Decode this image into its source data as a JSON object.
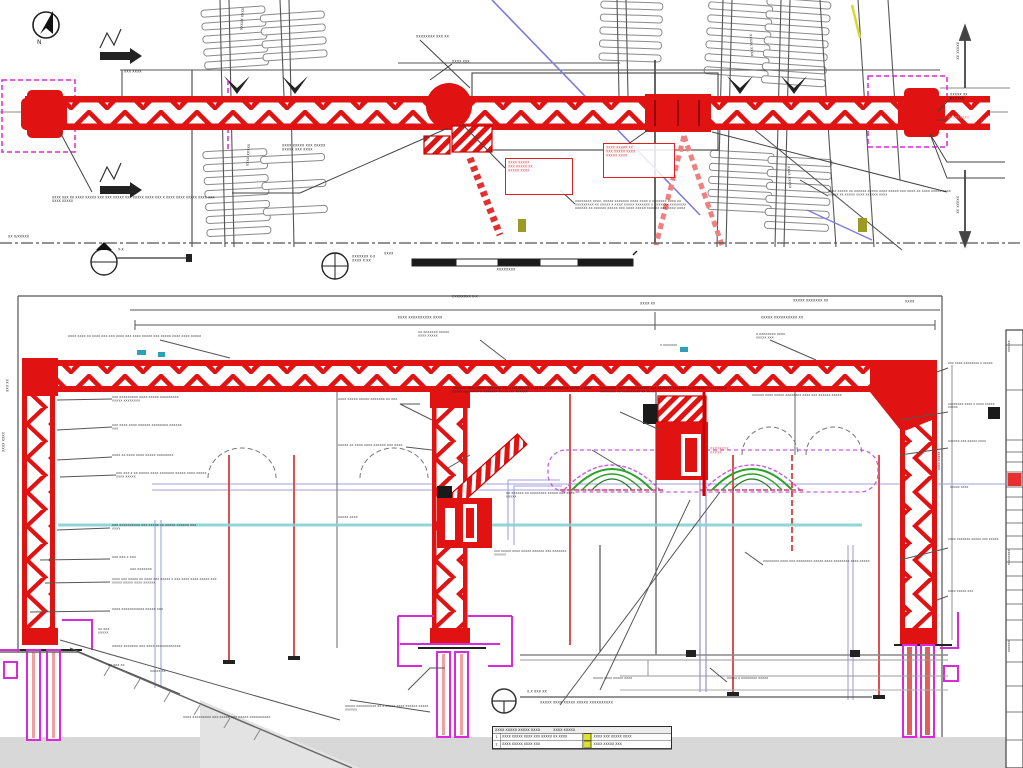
{
  "meta": {
    "drawing_type": "engineering CAD drawing — temporary gantry truss over railway: plan view (top) and elevation/section view (bottom)"
  },
  "colors": {
    "truss_red": "#e01212",
    "magenta": "#d92ad9",
    "cyan_level": "#85d2d4",
    "green_envelope": "#2ba32b",
    "purple_envelope": "#c55ddd",
    "lavender_line": "#a2a2dd",
    "blue_line": "#7d7de0",
    "yellow_mark": "#d8d82e",
    "ground_grey": "#d8d8d8",
    "legend_yellow": "#dede3a",
    "ink": "#1c1c1c"
  },
  "plan": {
    "annotations": [
      {
        "t": "XXXX XXXXX XXX XXXXX\nXXXXX XXX XXXX",
        "x": 282,
        "y": 144,
        "w": 86
      },
      {
        "t": "XXXX XXX XX XXXX XXXXX XXX XXX XXXXX XXX XXXXX XXXX XXX X XXXX XXXX XXXXX XXXX XXX XXXX XXXXX",
        "x": 52,
        "y": 196,
        "w": 168,
        "fs": 6.2
      },
      {
        "t": "XXXXXXXX XXXX. XXXXX XXXXXXX XXXX XXXX X XXXXXXX XXXX XX XXXXXXXXX XX XXXXX X XXXX XXXXX XXXXXXX X XXXXXXX XXXXXXXX XXXXXX XX XXXXXX XXXXX XXX XXXX XXXXX XXXXXX XXX XXXX XXXX",
        "x": 575,
        "y": 200,
        "w": 112,
        "fs": 5.8
      },
      {
        "t": "XXXX XXXXX XX XXXXXX XXXXX XXXX XXXXX XXX XXXX XX XXXX XXXXX XXXX XXXXX XX XXXXX XXXX XXXXXX XXXX",
        "x": 828,
        "y": 190,
        "w": 130,
        "fs": 5.8
      },
      {
        "t": "XXXXX XX\nXXXXXX",
        "x": 950,
        "y": 93,
        "w": 56
      },
      {
        "t": "XXXXXXXXX",
        "x": 948,
        "y": 116,
        "w": 60,
        "c": "#e87070"
      },
      {
        "t": "XXXXXXXX XXX XX",
        "x": 416,
        "y": 35,
        "w": 78
      },
      {
        "t": "XXXX XXX",
        "x": 452,
        "y": 60,
        "w": 50
      },
      {
        "t": "XXXXX XXXX",
        "x": 240,
        "y": 30,
        "r": -86
      },
      {
        "t": "XXXXX XXXX",
        "x": 752,
        "y": 34,
        "r": 86
      },
      {
        "t": "XXXX XXXXX",
        "x": 790,
        "y": 166,
        "r": 86
      },
      {
        "t": "XXXX XXXXX",
        "x": 246,
        "y": 166,
        "r": -86
      },
      {
        "t": "XXX XXXX",
        "x": 124,
        "y": 70,
        "w": 48
      },
      {
        "t": "XXXXX XX",
        "x": 959,
        "y": 42,
        "r": 90
      },
      {
        "t": "XXXXX XX",
        "x": 959,
        "y": 196,
        "r": 90
      },
      {
        "t": "XX X/XXXXX",
        "x": 8,
        "y": 235,
        "w": 58
      },
      {
        "t": "X-X",
        "x": 118,
        "y": 248,
        "w": 30
      }
    ],
    "callouts": [
      {
        "t": "XXXX XXXXX\nXXX XXXXX XX\nXXXXX XXXX",
        "x": 505,
        "y": 158,
        "w": 62,
        "h": 32
      },
      {
        "t": "XXXX XXXXX XX\nXXX XXXXX XXXX\nXXXXX XXXX",
        "x": 603,
        "y": 143,
        "w": 66,
        "h": 30
      }
    ]
  },
  "gap": {
    "annotations": [
      {
        "t": "XXXXXXX X-X\nXXXX X:XX",
        "x": 352,
        "y": 255,
        "w": 82
      },
      {
        "t": "XXXXXXXX",
        "x": 468,
        "y": 268,
        "w": 76,
        "ta": "center"
      },
      {
        "t": "XXXX",
        "x": 384,
        "y": 252,
        "w": 36
      }
    ]
  },
  "elevation": {
    "annotations": [
      {
        "t": "XXXX XXXX XX XXXX XXX XXX XXXX XXX XXXX XXXXX XXX XXXXX XXXX XXXX XXXXX",
        "x": 68,
        "y": 335,
        "w": 150,
        "fs": 5.8
      },
      {
        "t": "XX XXXXXXX XXXXX\nXXXX XXXXX",
        "x": 418,
        "y": 331,
        "w": 92,
        "fs": 5.8
      },
      {
        "t": "X XXXXXXXX XXXX\nXXXXX XXX",
        "x": 756,
        "y": 333,
        "w": 86,
        "fs": 5.8
      },
      {
        "t": "XXX XXXXXXXXX XXXX XXXXX XXXXXXXXX XXXXX XXXXXXXX",
        "x": 112,
        "y": 396,
        "w": 78,
        "fs": 5.8
      },
      {
        "t": "XXX XXXX XXXX XXXXXX XXXXXXXX XXXXXX XXX",
        "x": 112,
        "y": 424,
        "w": 74,
        "fs": 5.8
      },
      {
        "t": "XXXX XX XXXX XXXX XXXXX XXXXXXXX",
        "x": 112,
        "y": 454,
        "w": 62,
        "fs": 5.8
      },
      {
        "t": "XXX XXX X XX XXXXX XXXX XXXXXXX XXXXX XXXX XXXXX XXXX XXXXX",
        "x": 116,
        "y": 472,
        "w": 96,
        "fs": 5.8
      },
      {
        "t": "XXX XXXXXXXXXX XXX XXXXX XX XXXXX XXXXXX XXX XXXX",
        "x": 112,
        "y": 524,
        "w": 92,
        "fs": 5.8
      },
      {
        "t": "XXX XXX X XXX",
        "x": 112,
        "y": 556,
        "w": 70,
        "fs": 5.8
      },
      {
        "t": "XXX XXXXXXX",
        "x": 130,
        "y": 568,
        "w": 56,
        "fs": 5.8
      },
      {
        "t": "XXXX XXX XXXXX XX XXXX XXX XXXXX X XXX XXXX XXXX XXXXX XXX XXXXX XXXXX XXXX XXXXXX",
        "x": 112,
        "y": 578,
        "w": 112,
        "fs": 5.6
      },
      {
        "t": "XXXX XXXXXXXXXXX XXXXX XXX",
        "x": 112,
        "y": 608,
        "w": 70,
        "fs": 5.8
      },
      {
        "t": "XX XXX\nXXXXX",
        "x": 98,
        "y": 628,
        "w": 40,
        "fs": 5.8
      },
      {
        "t": "XXXXX XXXXXXX XXX XXXX XXXXXXXXXXXX",
        "x": 112,
        "y": 645,
        "w": 88,
        "fs": 5.8
      },
      {
        "t": "XX XXX XX",
        "x": 108,
        "y": 664,
        "w": 48,
        "fs": 5.8
      },
      {
        "t": "XXXXX XX",
        "x": 150,
        "y": 670,
        "w": 42,
        "fs": 5.8
      },
      {
        "t": "XXXX XXXXXXXXX XXX XXXXX XXX XXXXX XXXXXXXXXX",
        "x": 183,
        "y": 716,
        "w": 110,
        "fs": 5.8
      },
      {
        "t": "XXXX XXXXX XXXXX XXXXXXX XX XXX",
        "x": 338,
        "y": 398,
        "w": 80,
        "fs": 5.8
      },
      {
        "t": "XXXXX XX XXXX XXXX XXXXXX XXX XXXX",
        "x": 338,
        "y": 444,
        "w": 68,
        "fs": 5.8
      },
      {
        "t": "XXXXX XXXX",
        "x": 338,
        "y": 516,
        "w": 56,
        "fs": 5.8
      },
      {
        "t": "XXXXXXX XXXX XXXXX XXXXXXX XXX XXXXXXXXXX XXXX XXXXXXXXXXXX XX XXXXX X XXXX XXXXX XXXXXXXX X XXXXXXX XXXXXXXX XXXXXX",
        "x": 452,
        "y": 387,
        "w": 140,
        "fs": 5.6
      },
      {
        "t": "XXXXXXXX XXXX XXXXX XXXXXX XXX XXXXXXX XXXXXXX XX XXXXXXX X XXXXXXXX XXXXXXXX XX XXXXXXXXX XX XXXXX",
        "x": 600,
        "y": 387,
        "w": 140,
        "fs": 5.6
      },
      {
        "t": "XX XXXXXX XX XXXXXXXX XXXXX XXX XXXX XXXXX",
        "x": 506,
        "y": 492,
        "w": 76,
        "fs": 5.8
      },
      {
        "t": "XXX XXXXX XXXX XXXXX XXXXXX XXX XXXXXXX XXXXXX",
        "x": 494,
        "y": 550,
        "w": 84,
        "fs": 5.6
      },
      {
        "t": "XXXXXXXX\nXXXXX",
        "x": 710,
        "y": 447,
        "w": 60,
        "c": "#e05555"
      },
      {
        "t": "XXXXXX XXXX XXXXX XXXXXXXX XXXX XXX XXXXXX XXXXX",
        "x": 752,
        "y": 394,
        "w": 98,
        "fs": 5.6
      },
      {
        "t": "XXX XXXX XXXXXXXX X XXXXX",
        "x": 948,
        "y": 362,
        "w": 56,
        "fs": 5.4
      },
      {
        "t": "XXXXXXXX XXXX X XXXX XXXXX XXXXX",
        "x": 948,
        "y": 403,
        "w": 56,
        "fs": 5.4
      },
      {
        "t": "XXXXXX XXX XXXXX XXXX",
        "x": 948,
        "y": 440,
        "w": 56,
        "fs": 5.4
      },
      {
        "t": "XXXXX XXXX",
        "x": 950,
        "y": 486,
        "w": 50,
        "fs": 5.4
      },
      {
        "t": "XXXX XXXXXXX XXXXX XXX XXXXX",
        "x": 948,
        "y": 538,
        "w": 56,
        "fs": 5.4
      },
      {
        "t": "XXXX XXXXX XXX",
        "x": 948,
        "y": 590,
        "w": 52,
        "fs": 5.4
      },
      {
        "t": "XXXXXXXX XXXX XXX XXXXXXXX XXXXX XXXX XXXXXXXX XXXX XXXXX",
        "x": 763,
        "y": 560,
        "w": 118,
        "fs": 5.6
      },
      {
        "t": "XXXXX X XXXXXXXX XXXXX",
        "x": 727,
        "y": 677,
        "w": 70,
        "fs": 5.6
      },
      {
        "t": "XXXXX XXXX XXXXX XXXX",
        "x": 593,
        "y": 677,
        "w": 70,
        "fs": 5.6
      },
      {
        "t": "X.X XXX XX",
        "x": 527,
        "y": 690,
        "w": 60
      },
      {
        "t": "XXXXX XXXX  XXXXX XXXXX XXXXXXXXXX",
        "x": 540,
        "y": 701,
        "w": 240
      },
      {
        "t": "XXXXX XXXXXXXXXX XX X XXXXX XXXX XXXXXX XXXXX XXXXXX",
        "x": 345,
        "y": 705,
        "w": 90,
        "fs": 5.6
      },
      {
        "t": "XXXX XXXX",
        "x": 2,
        "y": 452,
        "r": -90
      },
      {
        "t": "XXX XX",
        "x": 6,
        "y": 392,
        "r": -90
      },
      {
        "t": "XXXX XXXXX",
        "x": 938,
        "y": 470,
        "r": -90,
        "fs": 5.4
      },
      {
        "t": "XXXXXX",
        "x": 1008,
        "y": 352,
        "r": -90,
        "fs": 5.4
      },
      {
        "t": "XXXXXXXX",
        "x": 1008,
        "y": 565,
        "r": -90,
        "fs": 5.4
      },
      {
        "t": "XXXXXX",
        "x": 1008,
        "y": 652,
        "r": -90,
        "fs": 5.4
      },
      {
        "t": "XXXXXXXX X-X",
        "x": 452,
        "y": 295,
        "w": 62
      },
      {
        "t": "XXXX XX",
        "x": 640,
        "y": 302,
        "w": 46
      },
      {
        "t": "XXXXX XXXXXXX XX",
        "x": 793,
        "y": 299,
        "w": 74
      },
      {
        "t": "XXXX XXXXXXXXXX XXXX",
        "x": 360,
        "y": 316,
        "w": 120,
        "ta": "center"
      },
      {
        "t": "XXXXX XXXXXXXXXX XX",
        "x": 722,
        "y": 316,
        "w": 120,
        "ta": "center"
      },
      {
        "t": "XXXX",
        "x": 905,
        "y": 300,
        "w": 40
      },
      {
        "t": "X XXXXXXX",
        "x": 660,
        "y": 344,
        "w": 44,
        "fs": 5.6
      }
    ],
    "legend": {
      "x": 492,
      "y": 726,
      "w": 178,
      "header_left": "XXXX XXXXX XXXXX XXXX",
      "header_right": "XXXX XXXXX",
      "rows": [
        {
          "no": "1",
          "cause": "XXXX XXXXX XXXX XXX XXXXX XX XXXX",
          "control": "XXXX XXX XXXXX XXXX"
        },
        {
          "no": "2",
          "cause": "XXXX XXXXX XXXX XXX",
          "control": "XXXX XXXXX XXX"
        }
      ]
    }
  }
}
